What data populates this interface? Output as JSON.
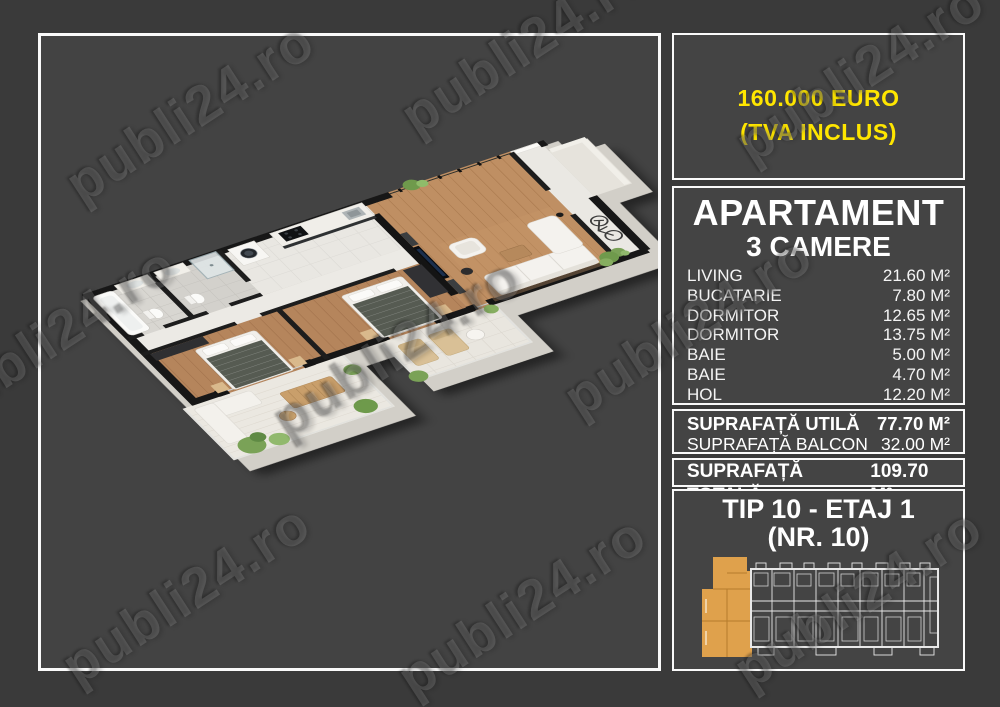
{
  "price": {
    "line1": "160.000 EURO",
    "line2": "(TVA INCLUS)"
  },
  "apartment": {
    "title": "APARTAMENT",
    "subtitle": "3 CAMERE",
    "rooms": [
      {
        "label": "LIVING",
        "area": "21.60 M²"
      },
      {
        "label": "BUCATARIE",
        "area": "7.80 M²"
      },
      {
        "label": "DORMITOR",
        "area": "12.65 M²"
      },
      {
        "label": "DORMITOR",
        "area": "13.75 M²"
      },
      {
        "label": "BAIE",
        "area": "5.00 M²"
      },
      {
        "label": "BAIE",
        "area": "4.70 M²"
      },
      {
        "label": "HOL",
        "area": "12.20 M²"
      }
    ]
  },
  "surfaces": {
    "utila_label": "SUPRAFAȚĂ UTILĂ",
    "utila_value": "77.70 M²",
    "balcon_label": "SUPRAFAȚĂ BALCON",
    "balcon_value": "32.00 M²",
    "totala_label": "SUPRAFAȚĂ TOTALĂ",
    "totala_value": "109.70 M²"
  },
  "unit": {
    "line1": "TIP 10 - ETAJ 1",
    "line2": "(NR. 10)"
  },
  "watermark": {
    "text": "publi24.ro"
  },
  "colors": {
    "background": "#3a3a3a",
    "box_background": "#444444",
    "panel_border": "#ffffff",
    "accent_yellow": "#ffe600",
    "highlight_orange": "#dfa14c",
    "wood_floor": "#b5855c"
  }
}
